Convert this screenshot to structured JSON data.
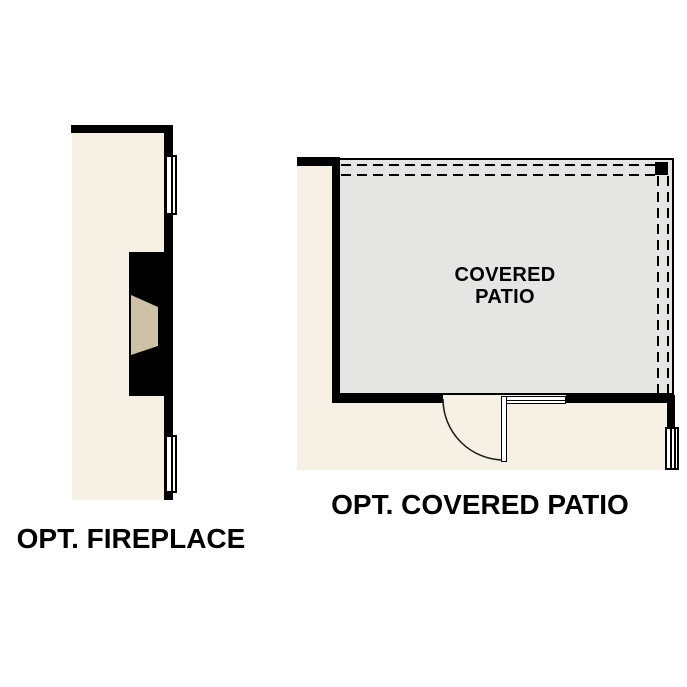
{
  "canvas": {
    "width": 687,
    "height": 687,
    "background": "#ffffff"
  },
  "colors": {
    "wall": "#000000",
    "interior_fill": "#f7f0e5",
    "patio_floor_fill": "#e5e5e3",
    "hearth_fill": "#cdc1a6",
    "line": "#1a1a1a",
    "text": "#000000"
  },
  "fireplace": {
    "caption": "OPT. FIREPLACE"
  },
  "patio": {
    "caption": "OPT. COVERED PATIO",
    "room_label_line1": "COVERED",
    "room_label_line2": "PATIO"
  }
}
